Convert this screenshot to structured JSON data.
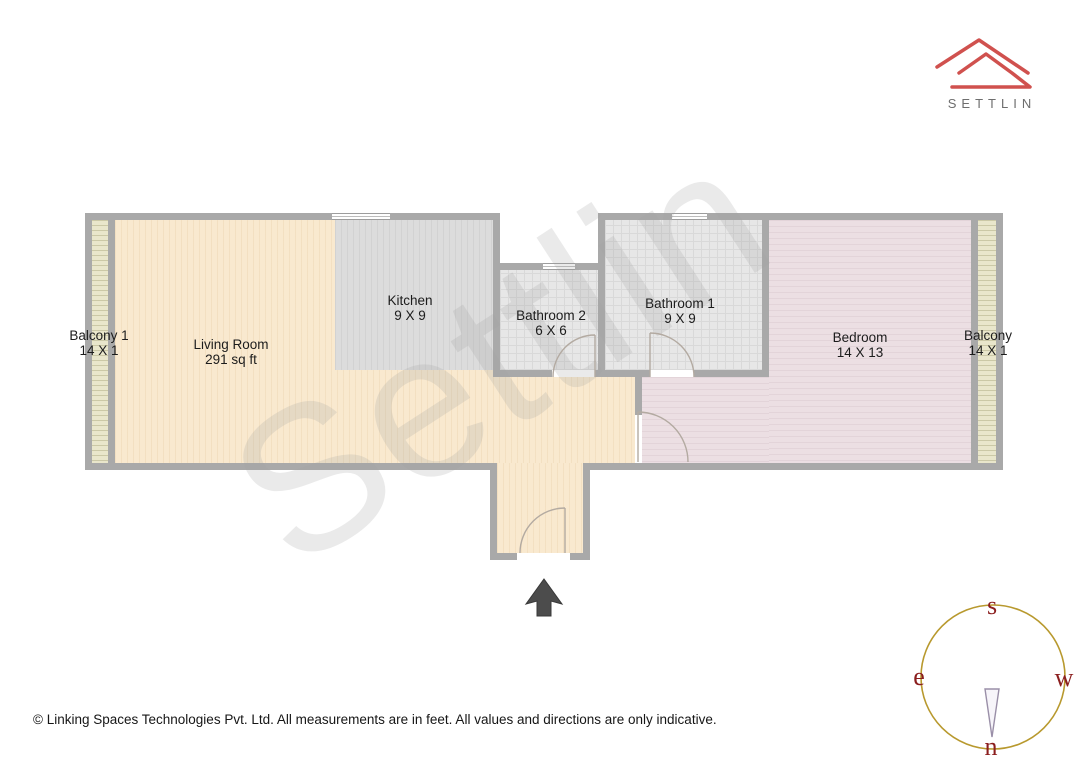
{
  "brand": {
    "name": "SETTLIN"
  },
  "watermark": {
    "text": "Settlin"
  },
  "plan": {
    "rooms": [
      {
        "id": "balcony-1",
        "label": "Balcony 1",
        "dims": "14 X 1"
      },
      {
        "id": "living-room",
        "label": "Living Room",
        "dims": "291 sq ft"
      },
      {
        "id": "kitchen",
        "label": "Kitchen",
        "dims": "9 X 9"
      },
      {
        "id": "bathroom-2",
        "label": "Bathroom 2",
        "dims": "6 X 6"
      },
      {
        "id": "bathroom-1",
        "label": "Bathroom 1",
        "dims": "9 X 9"
      },
      {
        "id": "bedroom",
        "label": "Bedroom",
        "dims": "14 X 13"
      },
      {
        "id": "balcony-2",
        "label": "Balcony",
        "dims": "14 X 1"
      }
    ],
    "colors": {
      "wall": "#a9a9a9",
      "living": "#f9e9cf",
      "kitchen": "#dcdcdc",
      "bathroom": "#e7e7e7",
      "bedroom": "#ecdfe3",
      "balcony": "#e9e6cb",
      "logo_red": "#d0514e",
      "compass_circle": "#b8992e",
      "compass_letters": "#8b1e1e",
      "entrance_arrow": "#4c4c4c"
    }
  },
  "compass": {
    "south": "s",
    "east": "e",
    "west": "w",
    "north": "n"
  },
  "footer": {
    "copyright": "© Linking Spaces Technologies Pvt. Ltd. All measurements are in feet. All values and directions are only indicative."
  }
}
